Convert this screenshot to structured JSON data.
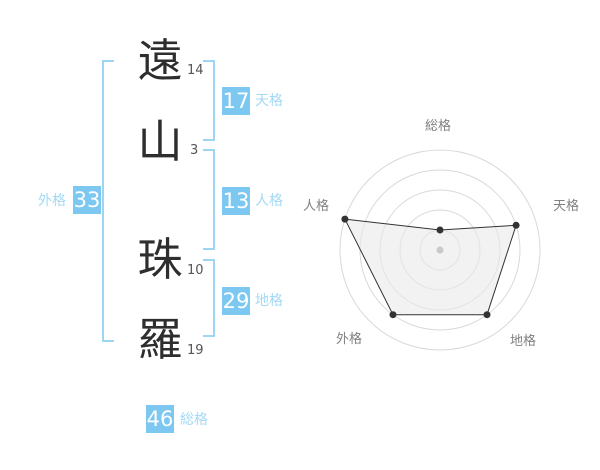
{
  "name": {
    "characters": [
      {
        "char": "遠",
        "strokes": "14"
      },
      {
        "char": "山",
        "strokes": "3"
      },
      {
        "char": "珠",
        "strokes": "10"
      },
      {
        "char": "羅",
        "strokes": "19"
      }
    ]
  },
  "scores": {
    "tenkaku": {
      "label": "天格",
      "value": "17"
    },
    "jinkaku": {
      "label": "人格",
      "value": "13"
    },
    "chikaku": {
      "label": "地格",
      "value": "29"
    },
    "gaikaku": {
      "label": "外格",
      "value": "33"
    },
    "soukaku": {
      "label": "総格",
      "value": "46"
    }
  },
  "colors": {
    "accent": "#7dc8f0",
    "accent_light": "#a3d9f5",
    "bracket": "#9dd6f3",
    "grid": "#d9d9d9",
    "series": "#333333",
    "series_fill": "#e9e9e9",
    "center_dot": "#c9c9c9",
    "label_gray": "#808080"
  },
  "chart_data": {
    "type": "radar",
    "axes": [
      "総格",
      "天格",
      "地格",
      "外格",
      "人格"
    ],
    "values": [
      1,
      4,
      4,
      4,
      5
    ],
    "max": 5,
    "rings": 5,
    "grid": "circular-no-spokes",
    "legend": "none",
    "start_angle_deg": -90,
    "direction": "clockwise",
    "center_marker": true
  }
}
